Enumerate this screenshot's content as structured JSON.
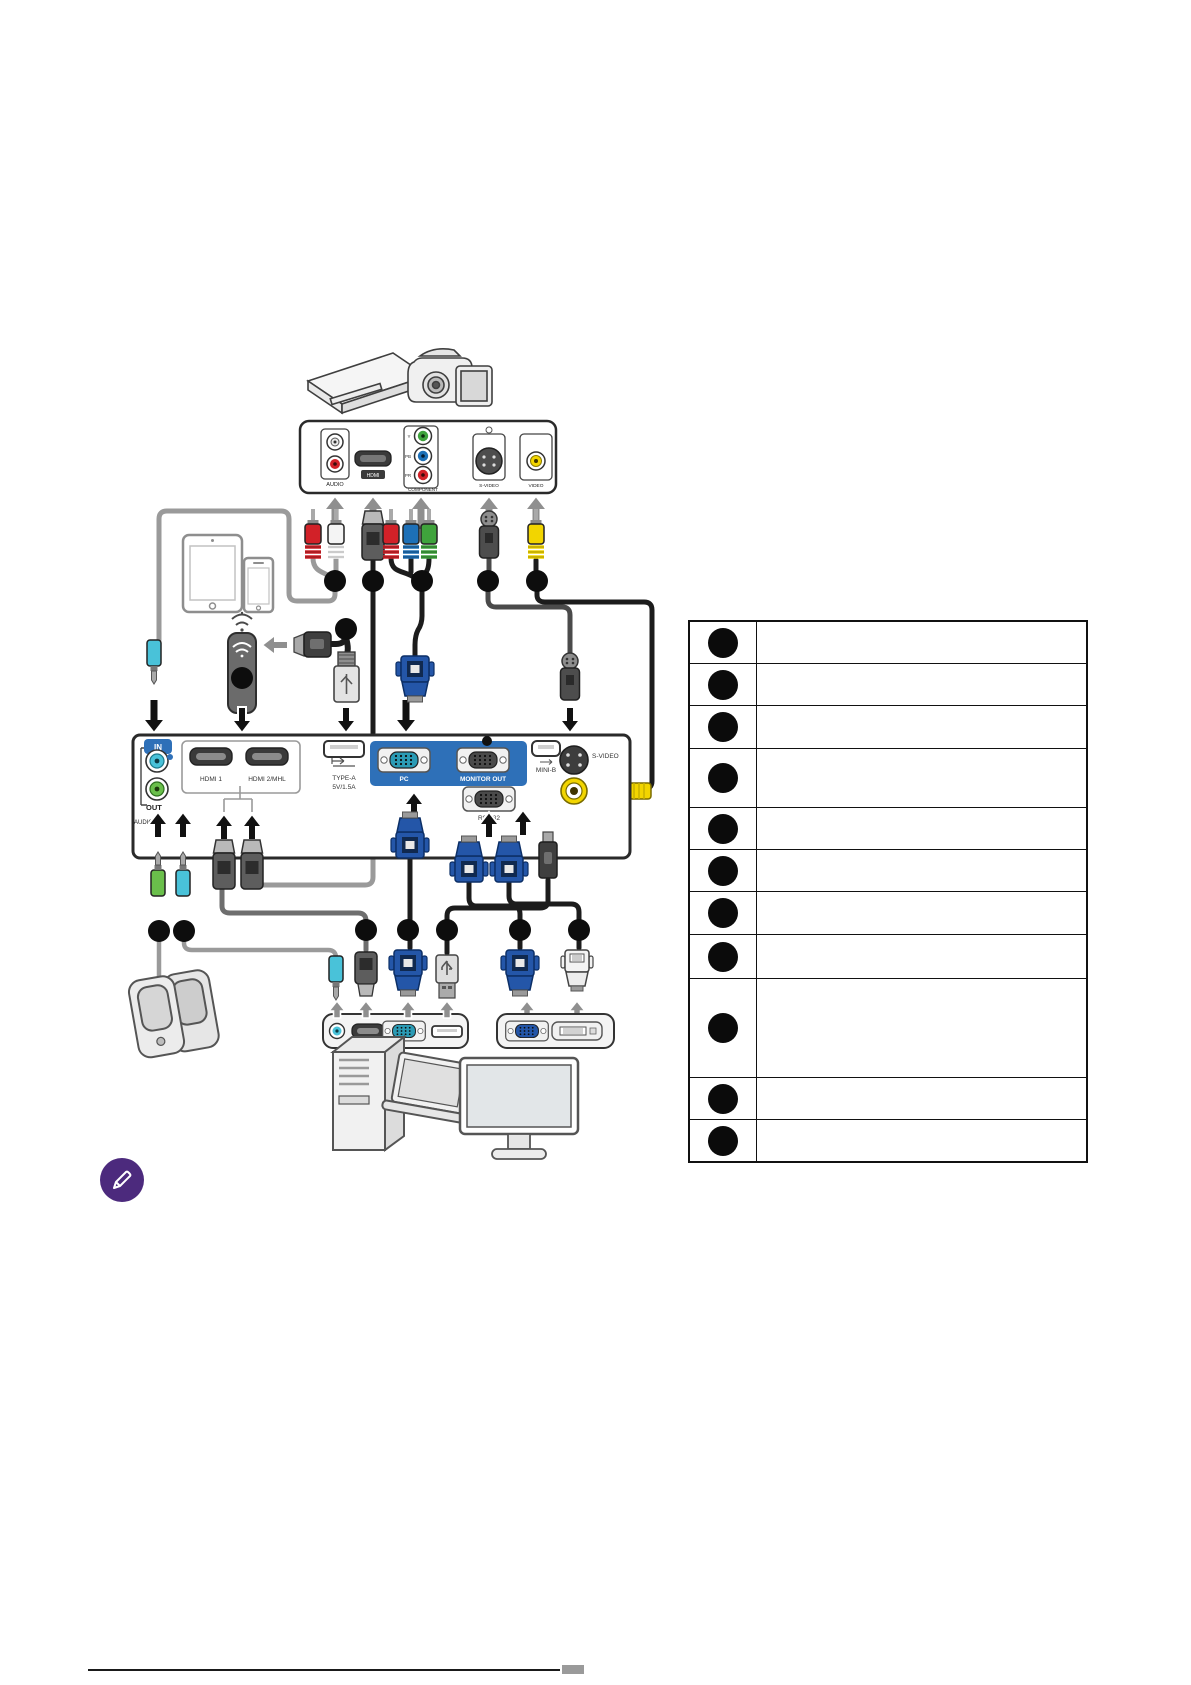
{
  "doc": {
    "kind": "projector-connection-diagram-page",
    "background": "#ffffff"
  },
  "av_device_panel": {
    "audio_label": "AUDIO",
    "hdmi_label": "HDMI",
    "component_label": "COMPONENT",
    "component_pins": {
      "y": "Y",
      "pb": "PB",
      "pr": "PR"
    },
    "s_video_label": "S-VIDEO",
    "video_label": "VIDEO"
  },
  "projector_panel": {
    "audio_in_label": "IN",
    "audio_out_label": "OUT",
    "audio_group_label": "AUDIO",
    "hdmi1_label": "HDMI 1",
    "hdmi2_label": "HDMI 2/MHL",
    "usb_type_a_label": "TYPE-A",
    "usb_type_a_power": "5V/1.5A",
    "pc_label": "PC",
    "monitor_out_label": "MONITOR OUT",
    "rs232_label": "RS-232",
    "mini_b_label": "MINI-B",
    "s_video_label": "S-VIDEO"
  },
  "legend": {
    "rows": [
      {
        "number": "",
        "label": ""
      },
      {
        "number": "",
        "label": ""
      },
      {
        "number": "",
        "label": ""
      },
      {
        "number": "",
        "label": ""
      },
      {
        "number": "",
        "label": ""
      },
      {
        "number": "",
        "label": ""
      },
      {
        "number": "",
        "label": ""
      },
      {
        "number": "",
        "label": ""
      },
      {
        "number": "",
        "label": ""
      },
      {
        "number": "",
        "label": ""
      },
      {
        "number": "",
        "label": ""
      }
    ]
  },
  "colors": {
    "panel_blue": "#2e70b8",
    "vga_blue": "#2456a8",
    "rca_red": "#d22128",
    "rca_white": "#f4f4f4",
    "component_green": "#3fa33c",
    "component_blue": "#1d70b7",
    "video_yellow": "#f2d500",
    "audio_cyan": "#49c2d9",
    "audio_green": "#6abf4b",
    "cable_gray": "#9a9a9a",
    "cable_dark": "#1c1c1c",
    "note_purple": "#4c2a7d"
  }
}
